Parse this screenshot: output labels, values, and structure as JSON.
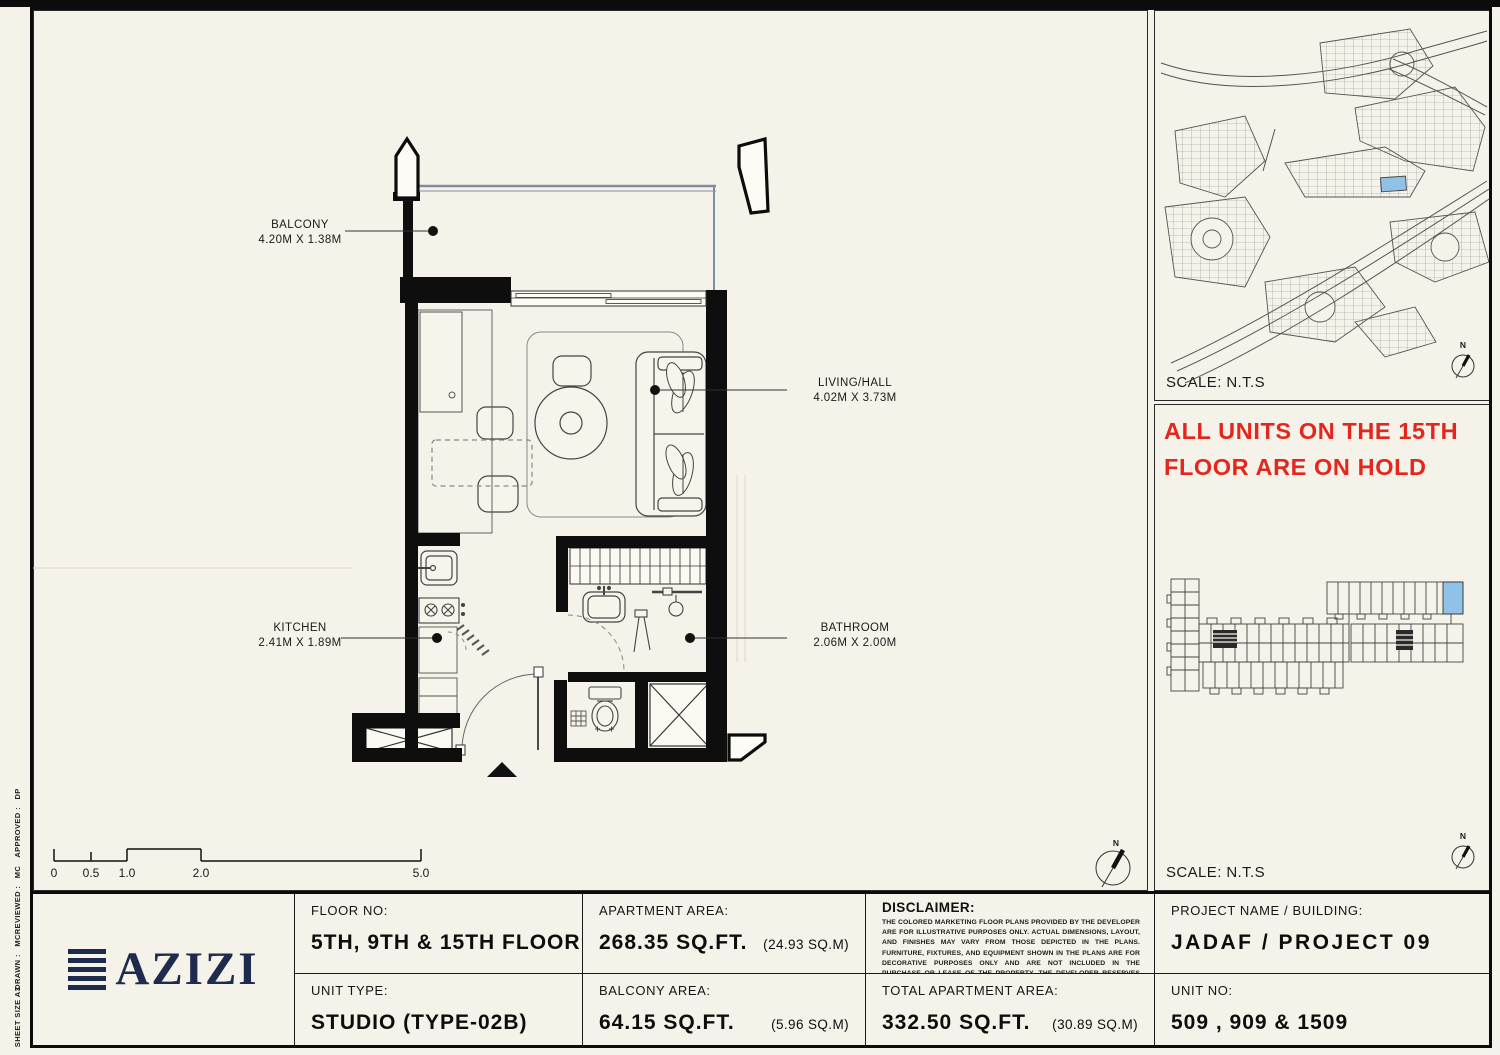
{
  "sheet_margin": {
    "items": [
      {
        "label": "APPROVED :   DP"
      },
      {
        "label": "REVIEWED :   MC"
      },
      {
        "label": "DRAWN :   MC"
      },
      {
        "label": "SHEET SIZE A3"
      }
    ]
  },
  "plan": {
    "rooms": {
      "balcony": {
        "name": "BALCONY",
        "dims": "4.20M X 1.38M"
      },
      "living": {
        "name": "LIVING/HALL",
        "dims": "4.02M X 3.73M"
      },
      "kitchen": {
        "name": "KITCHEN",
        "dims": "2.41M X 1.89M"
      },
      "bathroom": {
        "name": "BATHROOM",
        "dims": "2.06M X 2.00M"
      }
    },
    "scale_bar": {
      "ticks": [
        "0",
        "0.5",
        "1.0",
        "2.0",
        "5.0"
      ]
    },
    "north_label": "N"
  },
  "sidebar": {
    "site_map": {
      "scale_label": "SCALE: N.T.S",
      "north_label": "N"
    },
    "hold_notice": {
      "line1": "ALL UNITS ON THE 15TH",
      "line2": "FLOOR ARE ON HOLD"
    },
    "key_plan": {
      "scale_label": "SCALE: N.T.S",
      "north_label": "N"
    }
  },
  "title_block": {
    "logo": {
      "text": "AZIZI"
    },
    "floor_no": {
      "label": "FLOOR NO:",
      "value": "5TH, 9TH & 15TH FLOOR"
    },
    "unit_type": {
      "label": "UNIT TYPE:",
      "value": "STUDIO (TYPE-02B)"
    },
    "apartment_area": {
      "label": "APARTMENT AREA:",
      "value": "268.35 SQ.FT.",
      "metric": "(24.93 SQ.M)"
    },
    "balcony_area": {
      "label": "BALCONY AREA:",
      "value": "64.15 SQ.FT.",
      "metric": "(5.96 SQ.M)"
    },
    "disclaimer": {
      "label": "DISCLAIMER:",
      "text": "THE COLORED MARKETING FLOOR PLANS PROVIDED BY THE DEVELOPER ARE FOR ILLUSTRATIVE PURPOSES ONLY. ACTUAL DIMENSIONS, LAYOUT, AND FINISHES MAY VARY FROM THOSE DEPICTED IN THE PLANS. FURNITURE, FIXTURES, AND EQUIPMENT SHOWN IN THE PLANS ARE FOR DECORATIVE PURPOSES ONLY AND ARE NOT INCLUDED IN THE PURCHASE OR LEASE OF THE PROPERTY. THE DEVELOPER RESERVES THE RIGHT TO MAKE MODIFICATIONS, REVISIONS, AND CHANGES TO THE FLOOR PLANS, SPECIFICATIONS, AND FEATURES WITHOUT PRIOR NOTICE."
    },
    "total_area": {
      "label": "TOTAL APARTMENT AREA:",
      "value": "332.50 SQ.FT.",
      "metric": "(30.89 SQ.M)"
    },
    "project": {
      "label": "PROJECT NAME / BUILDING:",
      "value": "JADAF / PROJECT 09"
    },
    "unit_no": {
      "label": "UNIT NO:",
      "value": "509 , 909 & 1509"
    }
  },
  "colors": {
    "paper": "#f5f2e9",
    "ink": "#111111",
    "navy": "#1d2b4d",
    "red": "#e5261d",
    "highlight_blue": "#8fc2e6",
    "glass": "#7e8ea4"
  }
}
